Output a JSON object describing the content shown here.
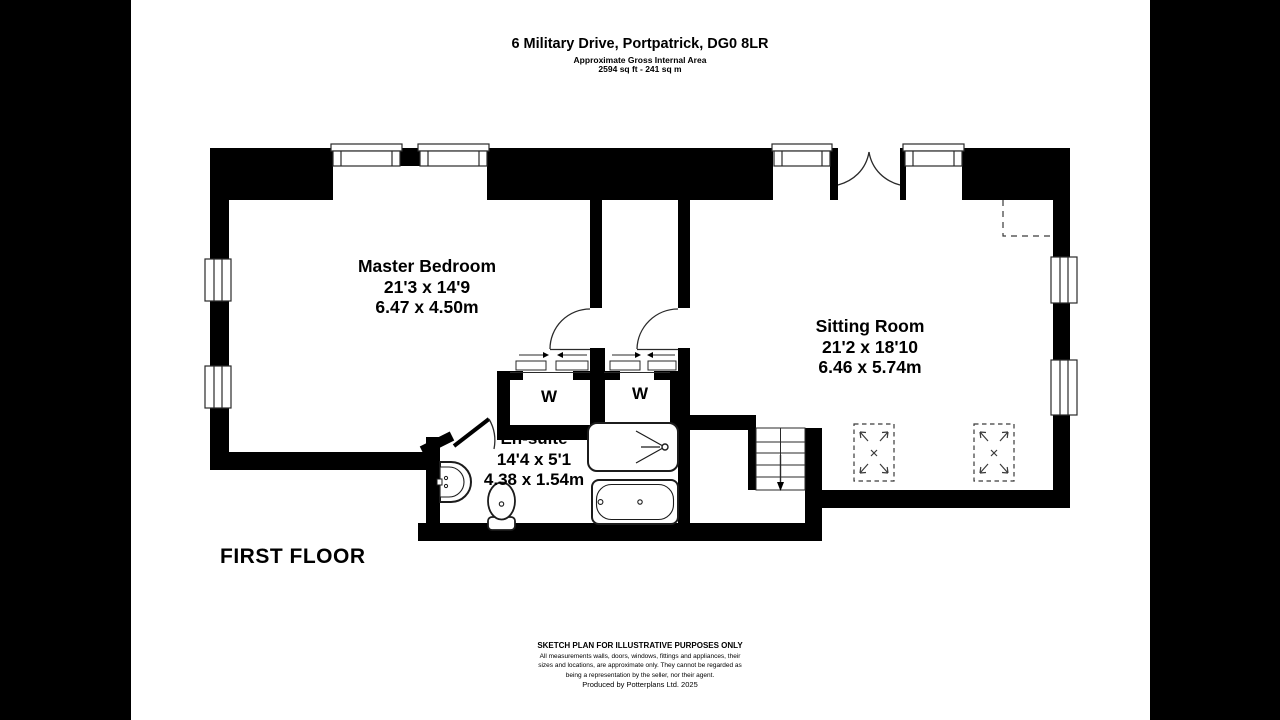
{
  "header": {
    "title": "6 Military Drive, Portpatrick, DG0 8LR",
    "subtitle": "Approximate Gross Internal Area",
    "area": "2594 sq ft - 241 sq m"
  },
  "plan": {
    "floor_label": "FIRST FLOOR",
    "rooms": {
      "master_bedroom": {
        "name": "Master Bedroom",
        "dims_imperial": "21'3 x 14'9",
        "dims_metric": "6.47 x 4.50m"
      },
      "sitting_room": {
        "name": "Sitting Room",
        "dims_imperial": "21'2 x 18'10",
        "dims_metric": "6.46 x 5.74m"
      },
      "ensuite": {
        "name": "En-suite",
        "dims_imperial": "14'4 x 5'1",
        "dims_metric": "4.38 x 1.54m"
      }
    },
    "wardrobes": {
      "left_label": "W",
      "right_label": "W"
    }
  },
  "footer": {
    "notice": "SKETCH PLAN FOR ILLUSTRATIVE PURPOSES ONLY",
    "disclaimer_line1": "All measurements walls, doors, windows, fittings and appliances, their",
    "disclaimer_line2": "sizes and locations, are approximate only. They cannot be regarded as",
    "disclaimer_line3": "being a representation by the seller, nor their agent.",
    "credit": "Produced by Potterplans Ltd. 2025"
  },
  "colors": {
    "wall": "#000000",
    "paper": "#ffffff",
    "letterbox": "#000000",
    "line": "#3a3a3a"
  }
}
